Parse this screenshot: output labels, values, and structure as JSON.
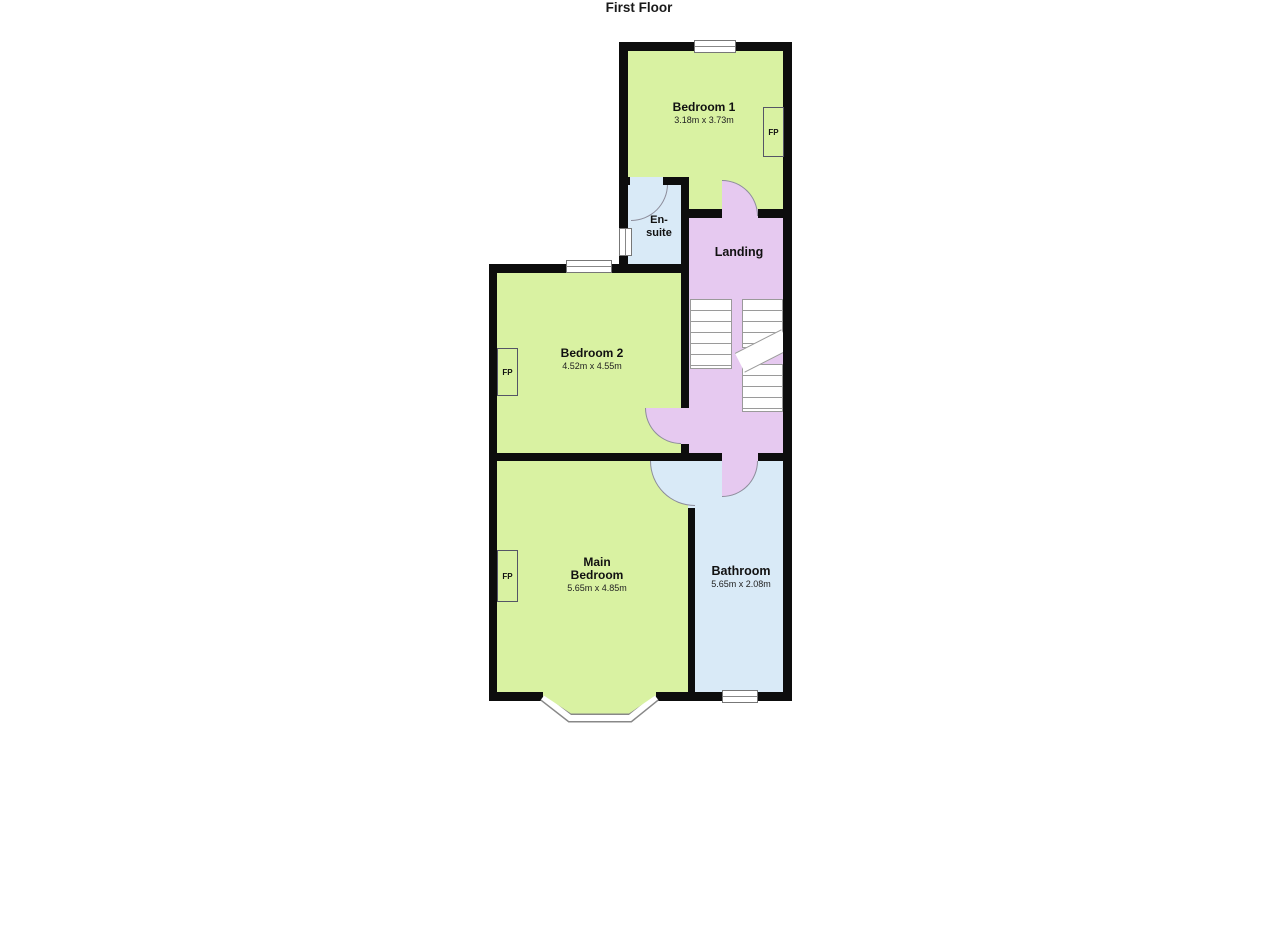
{
  "title": "First Floor",
  "colors": {
    "room_green": "#d9f2a2",
    "room_blue": "#d9eaf7",
    "room_purple": "#e6c9f0",
    "wall": "#0d0d0d"
  },
  "rooms": {
    "bedroom1": {
      "name": "Bedroom 1",
      "dims": "3.18m x 3.73m"
    },
    "ensuite": {
      "name_line1": "En-",
      "name_line2": "suite"
    },
    "landing": {
      "name": "Landing"
    },
    "bedroom2": {
      "name": "Bedroom 2",
      "dims": "4.52m x 4.55m"
    },
    "main_bedroom": {
      "name_line1": "Main",
      "name_line2": "Bedroom",
      "dims": "5.65m x 4.85m"
    },
    "bathroom": {
      "name": "Bathroom",
      "dims": "5.65m x 2.08m"
    }
  },
  "fireplace_label": "FP"
}
